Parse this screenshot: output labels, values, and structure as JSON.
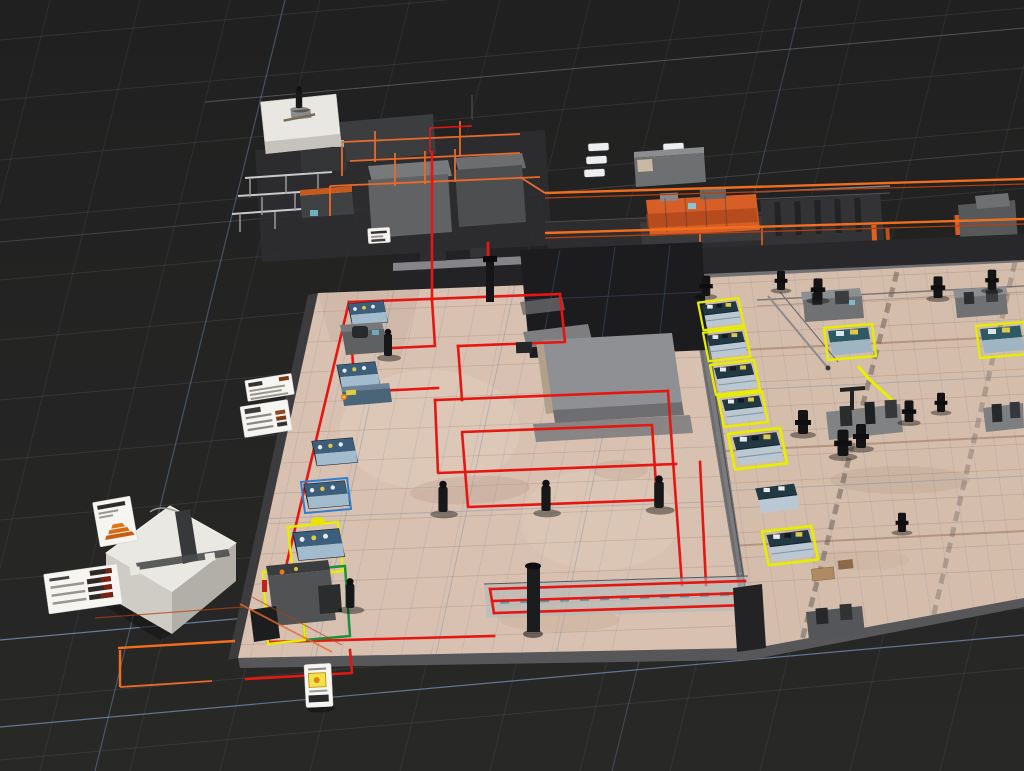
{
  "canvas": {
    "width": 1024,
    "height": 771,
    "background": "#232323"
  },
  "view": {
    "type": "isometric-3d-scene",
    "subject": "factory-floor-digital-twin",
    "grid": "perspective-grid"
  },
  "palette": {
    "background": "#232323",
    "grid_line": "#a0acbe",
    "grid_highlight_blue": "#94b4e4",
    "floor_left": "#d8c1b1",
    "floor_right": "#d5bdac",
    "floor_slab_edge": "#57575a",
    "platform_gray": "#8f9093",
    "dark_platform": "#2d2d2f",
    "agv_path_red": "#e41712",
    "pipe_orange": "#f26d1d",
    "machine_orange": "#d75f27",
    "machine_gray": "#606264",
    "console_top_blue": "#3d5e7a",
    "console_screen": "#a5bfd0",
    "console_top_navy": "#223944",
    "selection_yellow": "#e4ef00",
    "selection_green": "#1f8f3a",
    "selection_blue": "#2e7fd4",
    "white_building": "#eae8e2",
    "annotation_card": "#f6f5f2",
    "card_bar_dark": "#2e2a28",
    "card_bar_red": "#7c2014",
    "card_accent_orange": "#d8731f",
    "conveyor_teal": "#3e98aa",
    "worker_silhouette": "#17181a",
    "button_yellow": "#e0c84a",
    "button_white": "#e9e9eb"
  },
  "inventory": {
    "upper_processing_line": {
      "white_utility_building": 1,
      "machine_towers": 3,
      "rack_frames": 3,
      "orange_machine": 1,
      "white_vent_pads": 6,
      "overhead_conveyor_lines": 2
    },
    "left_floor": {
      "blue_consoles": 5,
      "gray_machines": 2,
      "yellow_selected": 2,
      "blue_selected": 1,
      "green_selected": 1,
      "workers": 5,
      "bottom_conveyor": 1
    },
    "right_floor": {
      "yellow_highlight_consoles": 6,
      "plain_consoles": 1,
      "workstations_with_selection": 2,
      "gray_machines": 4,
      "robot_silhouettes": 10,
      "yellow_guide_path": 1
    },
    "annotation_cards": [
      {
        "id": "card-top-1",
        "style": "small-list"
      },
      {
        "id": "card-top-2",
        "style": "list-with-orange-chips"
      },
      {
        "id": "card-left-1",
        "style": "orange-pyramid"
      },
      {
        "id": "card-left-2",
        "style": "list-with-red-bars"
      },
      {
        "id": "card-bottom",
        "style": "vertical-warning-tag"
      }
    ],
    "white_box_machine": {
      "t_handle": 1,
      "feet": 2
    }
  }
}
